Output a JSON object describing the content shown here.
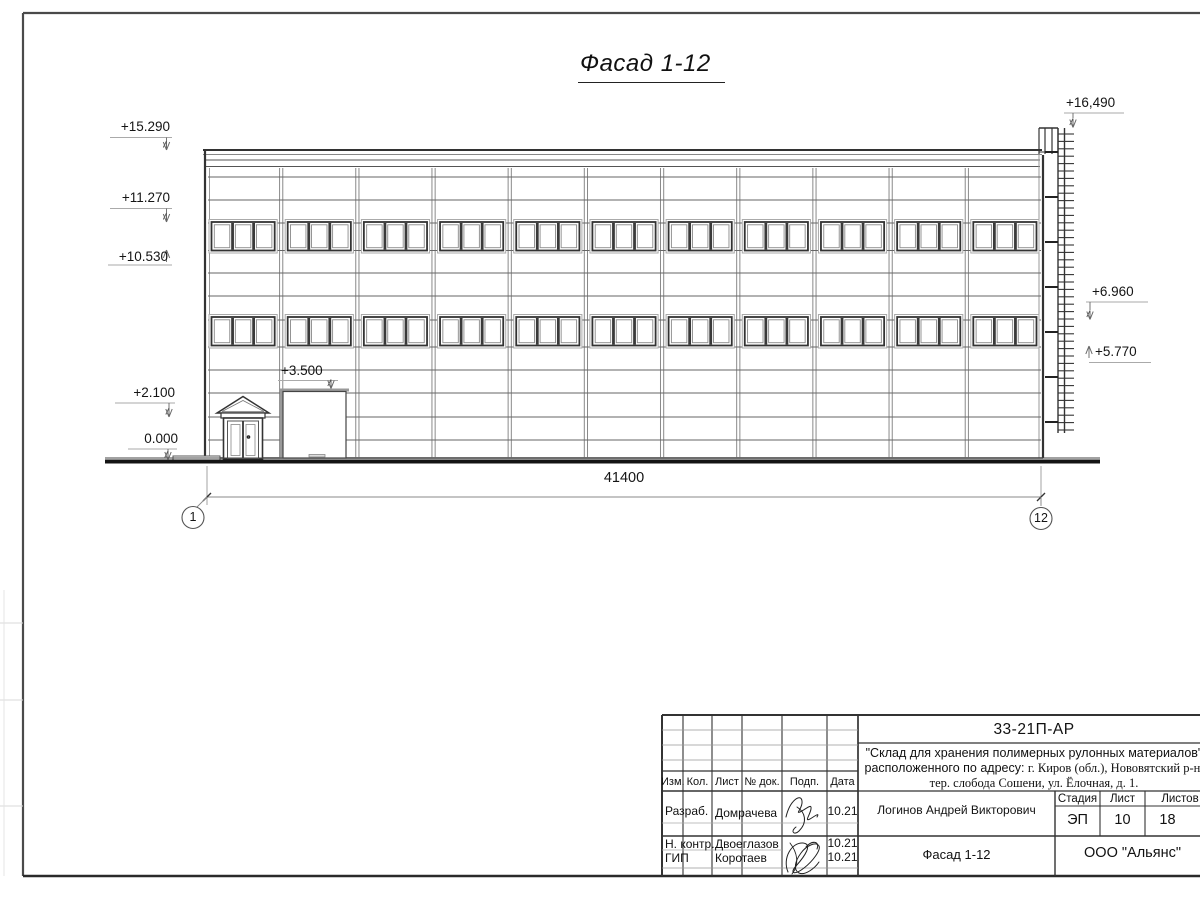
{
  "sheet": {
    "title": "Фасад 1-12",
    "dimension_total": "41400",
    "axis_start": "1",
    "axis_end": "12"
  },
  "facade": {
    "bays": 11,
    "window_rows": 2,
    "panes_per_window": 3,
    "ladder_rungs": 41,
    "ladder_brackets": 7
  },
  "elevations": {
    "parapet": "+15.290",
    "upper_window_head": "+11.270",
    "upper_window_sill": "+10.530",
    "canopy": "+2.100",
    "ground": "0.000",
    "gate_top": "+3.500",
    "ladder_top": "+16,490",
    "right_upper": "+6.960",
    "right_lower": "+5.770"
  },
  "titleblock": {
    "doc_code": "33-21П-АР",
    "project_line1": "\"Склад для хранения полимерных рулонных материалов\"",
    "project_line2a": "расположенного по адресу: ",
    "project_line2b": "г. Киров (обл.), Нововятский р-н,",
    "project_line3": "тер. слобода Сошени, ул. Ёлочная, д. 1.",
    "col_izm": "Изм.",
    "col_kol": "Кол.",
    "col_list": "Лист",
    "col_ndok": "№ док.",
    "col_podp": "Подп.",
    "col_data": "Дата",
    "row1_role": "Разраб.",
    "row1_name": "Домрачева",
    "row1_date": "10.21",
    "row2_role": "Н. контр.",
    "row2_name": "Двоеглазов",
    "row2_date": "10.21",
    "row3_role": "ГИП",
    "row3_name": "Коротаев",
    "row3_date": "10.21",
    "author": "Логинов Андрей Викторович",
    "stage_label": "Стадия",
    "sheet_label": "Лист",
    "sheets_label": "Листов",
    "stage_value": "ЭП",
    "sheet_value": "10",
    "sheets_value": "18",
    "drawing_name": "Фасад 1-12",
    "company": "ООО \"Альянс\""
  }
}
